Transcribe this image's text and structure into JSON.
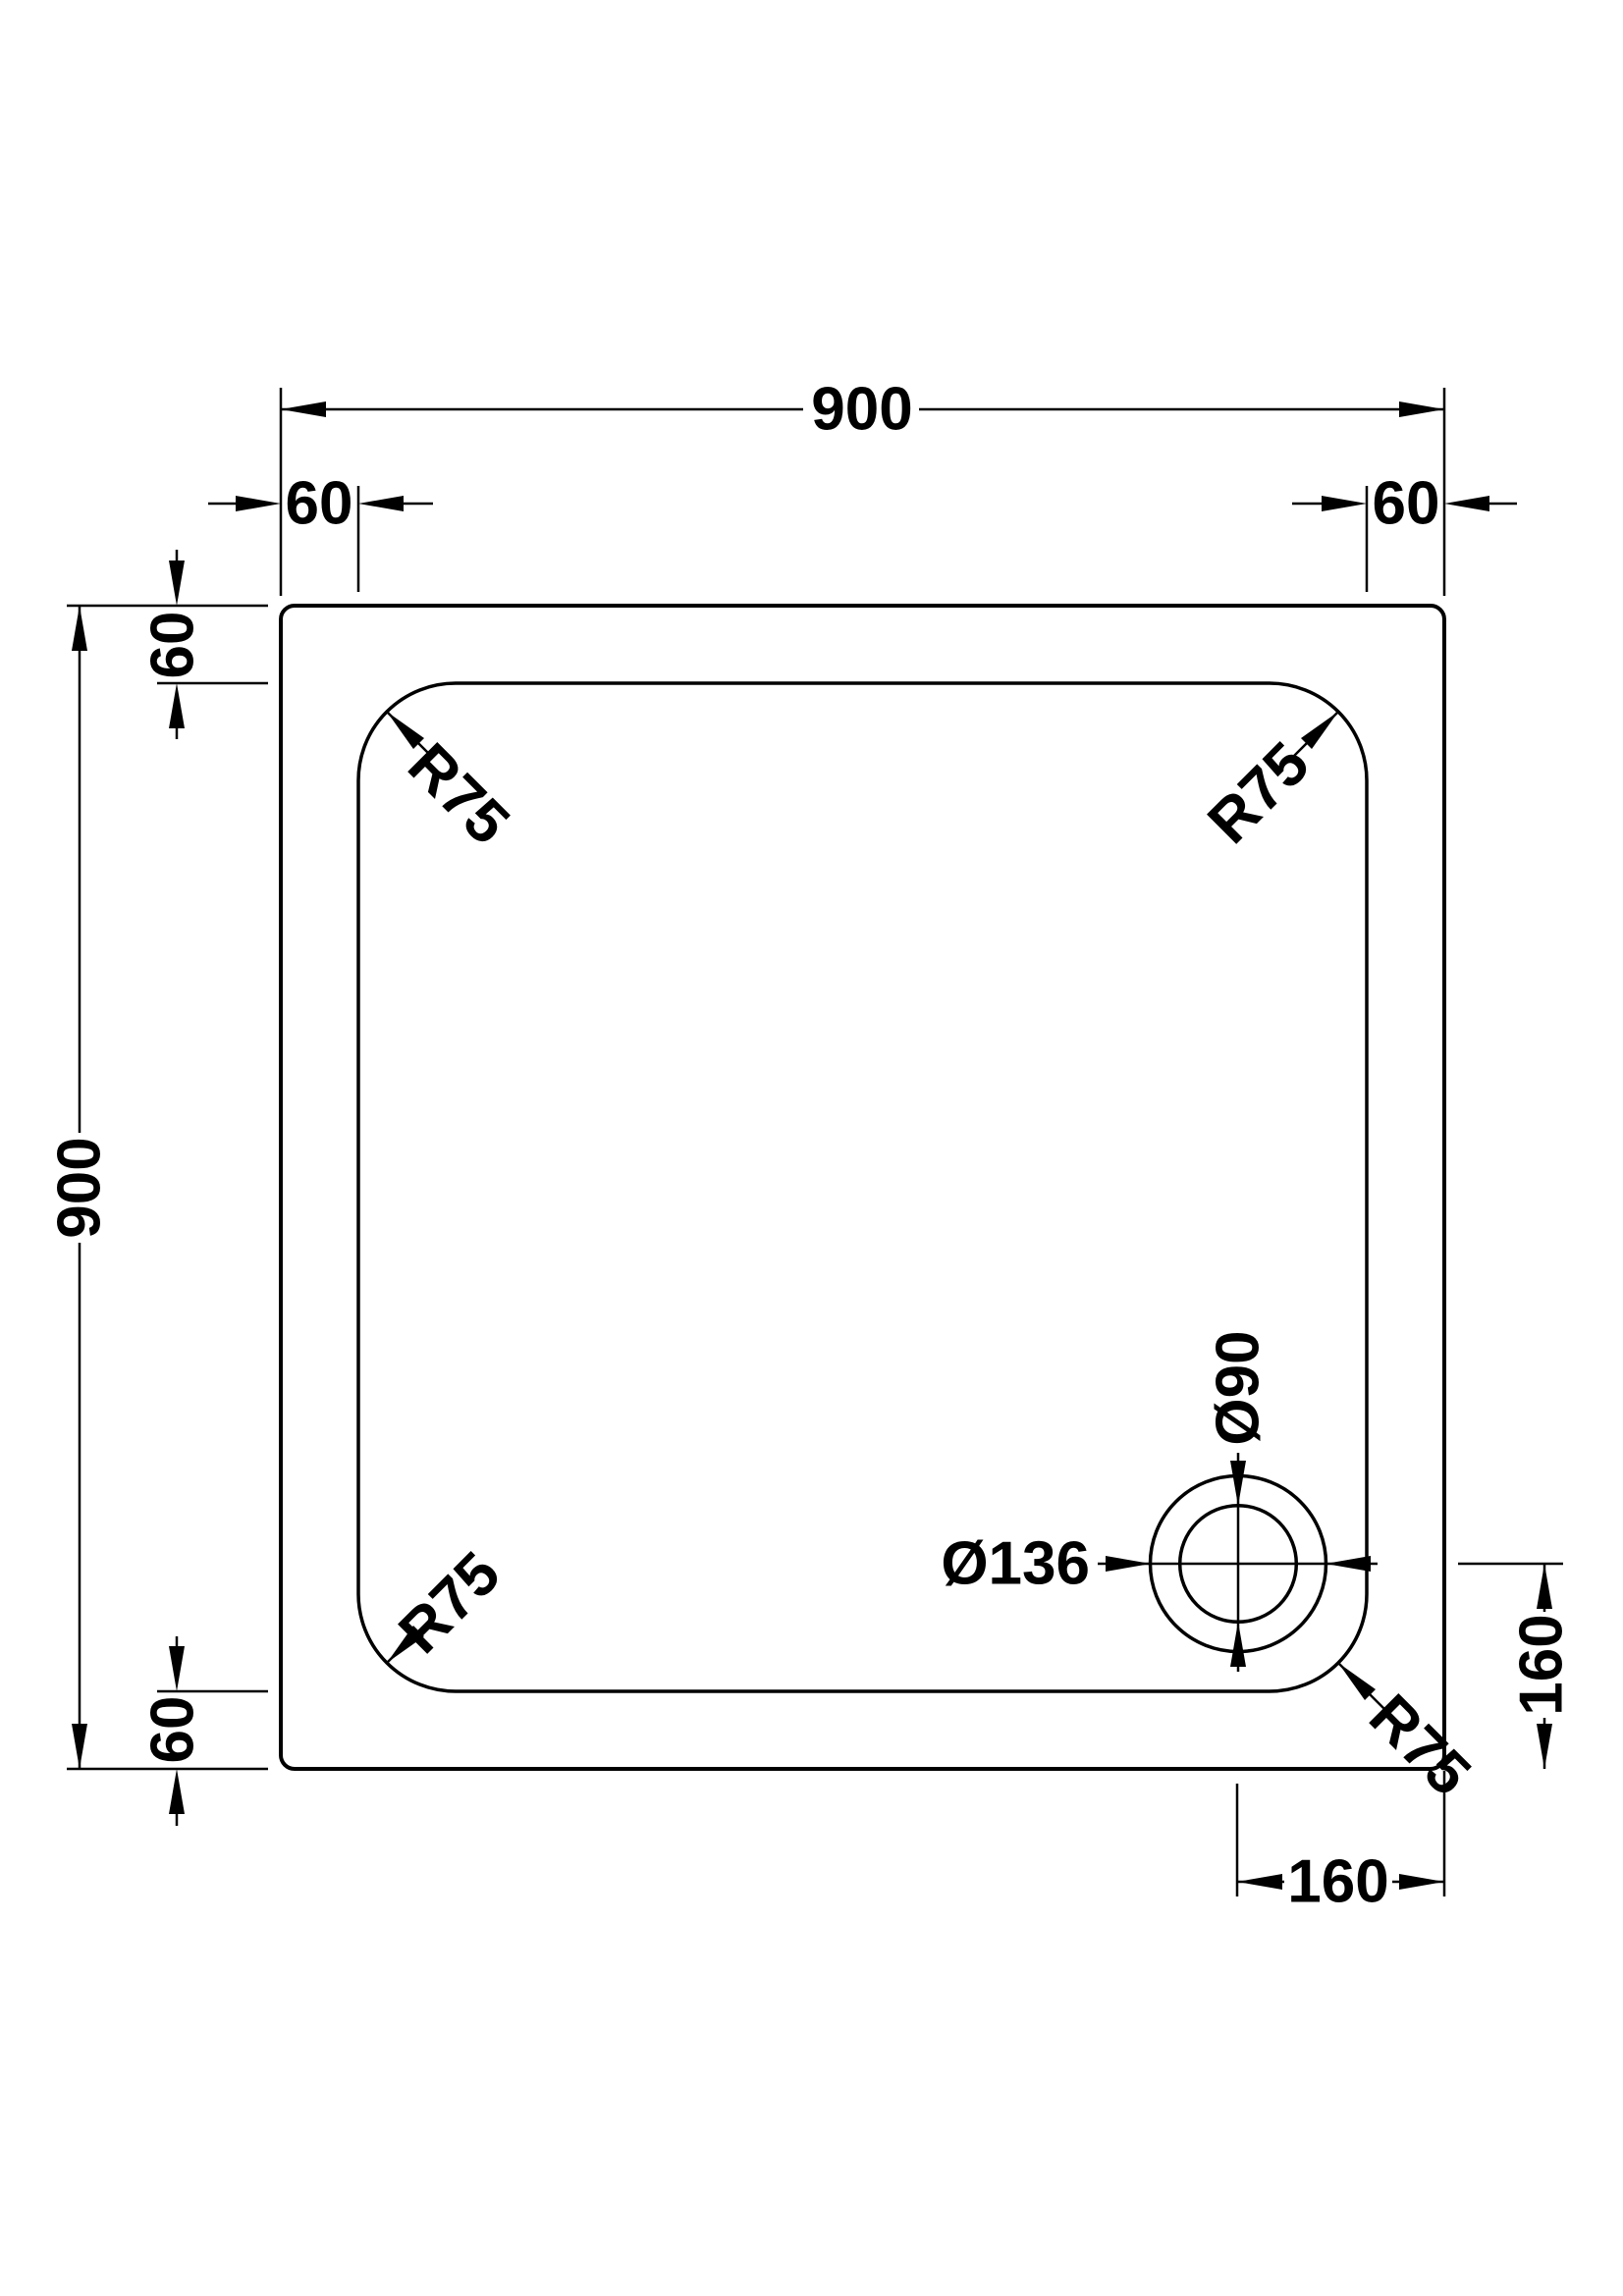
{
  "drawing": {
    "overall_width_label": "900",
    "overall_height_label": "900",
    "top_inset_left_label": "60",
    "top_inset_right_label": "60",
    "left_inset_top_label": "60",
    "left_inset_bottom_label": "60",
    "corner_radius_top_left_label": "R75",
    "corner_radius_top_right_label": "R75",
    "corner_radius_bottom_left_label": "R75",
    "corner_radius_bottom_right_label": "R75",
    "drain_inner_diameter_label": "Ø90",
    "drain_outer_diameter_label": "Ø136",
    "drain_offset_right_label": "160",
    "drain_offset_bottom_label": "160"
  }
}
